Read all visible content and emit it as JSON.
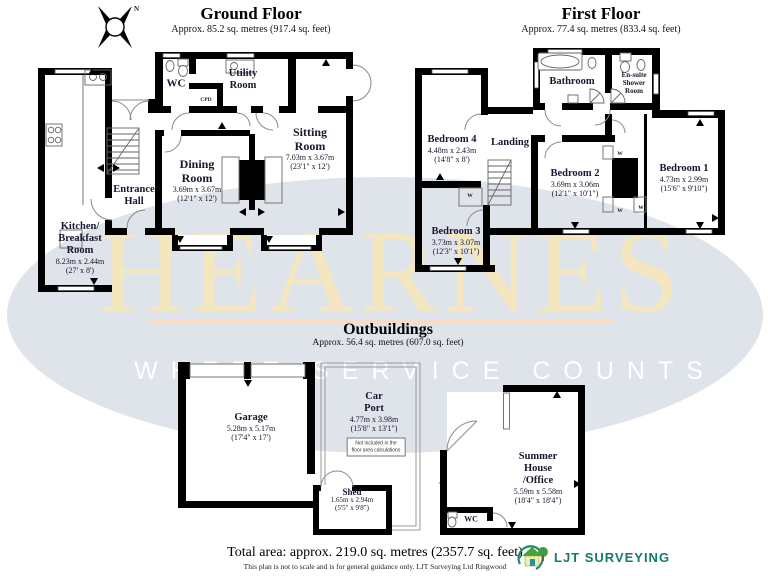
{
  "headers": {
    "ground": {
      "title": "Ground Floor",
      "subtitle": "Approx. 85.2 sq. metres (917.4 sq. feet)"
    },
    "first": {
      "title": "First Floor",
      "subtitle": "Approx. 77.4 sq. metres (833.4 sq. feet)"
    },
    "outbuildings": {
      "title": "Outbuildings",
      "subtitle": "Approx. 56.4 sq. metres (607.0 sq. feet)"
    }
  },
  "compass": {
    "north_label": "N"
  },
  "watermark": {
    "brand": "HEARNES",
    "tagline": "WHERE SERVICE COUNTS",
    "ellipse_color": "#dfe3ea",
    "brand_color": "#f4e7c0",
    "tagline_color": "#ffffff",
    "divider_color": "#f8dcc6"
  },
  "rooms": {
    "ground": {
      "wc": {
        "name": "WC"
      },
      "utility": {
        "name": "Utility\nRoom"
      },
      "cupboard": {
        "name": "CPD"
      },
      "entrance_hall": {
        "name": "Entrance\nHall"
      },
      "dining": {
        "name": "Dining\nRoom",
        "dim_m": "3.69m x 3.67m",
        "dim_ft": "(12'1\" x 12')"
      },
      "sitting": {
        "name": "Sitting\nRoom",
        "dim_m": "7.03m x 3.67m",
        "dim_ft": "(23'1\" x 12')"
      },
      "kitchen": {
        "name": "Kitchen/\nBreakfast\nRoom",
        "dim_m": "8.23m x 2.44m",
        "dim_ft": "(27' x 8')"
      }
    },
    "first": {
      "bathroom": {
        "name": "Bathroom"
      },
      "ensuite": {
        "name": "En-suite\nShower\nRoom"
      },
      "landing": {
        "name": "Landing"
      },
      "bedroom1": {
        "name": "Bedroom 1",
        "dim_m": "4.73m x 2.99m",
        "dim_ft": "(15'6\" x 9'10\")"
      },
      "bedroom2": {
        "name": "Bedroom 2",
        "dim_m": "3.69m x 3.06m",
        "dim_ft": "(12'1\" x 10'1\")"
      },
      "bedroom3": {
        "name": "Bedroom 3",
        "dim_m": "3.73m x 3.07m",
        "dim_ft": "(12'3\" x 10'1\")"
      },
      "bedroom4": {
        "name": "Bedroom 4",
        "dim_m": "4.48m x 2.43m",
        "dim_ft": "(14'8\" x 8')"
      },
      "wardrobe_label": "W"
    },
    "outbuildings": {
      "garage": {
        "name": "Garage",
        "dim_m": "5.28m x 5.17m",
        "dim_ft": "(17'4\" x 17')"
      },
      "carport": {
        "name": "Car\nPort",
        "dim_m": "4.77m x 3.98m",
        "dim_ft": "(15'8\" x 13'1\")",
        "note": "Not included in the\nfloor area calculations"
      },
      "shed": {
        "name": "Shed",
        "dim_m": "1.65m x 2.94m",
        "dim_ft": "(5'5\" x 9'8\")"
      },
      "summer_house": {
        "name": "Summer\nHouse\n/Office",
        "dim_m": "5.59m x 5.58m",
        "dim_ft": "(18'4\" x 18'4\")"
      },
      "wc": {
        "name": "WC"
      }
    }
  },
  "footer": {
    "total_area": "Total area: approx. 219.0 sq. metres (2357.7 sq. feet)",
    "disclaimer": "This plan is not to scale and is for general guidance only. LJT Surveying Ltd Ringwood",
    "logo_text": "LJT Surveying",
    "logo_color": "#17796a"
  }
}
